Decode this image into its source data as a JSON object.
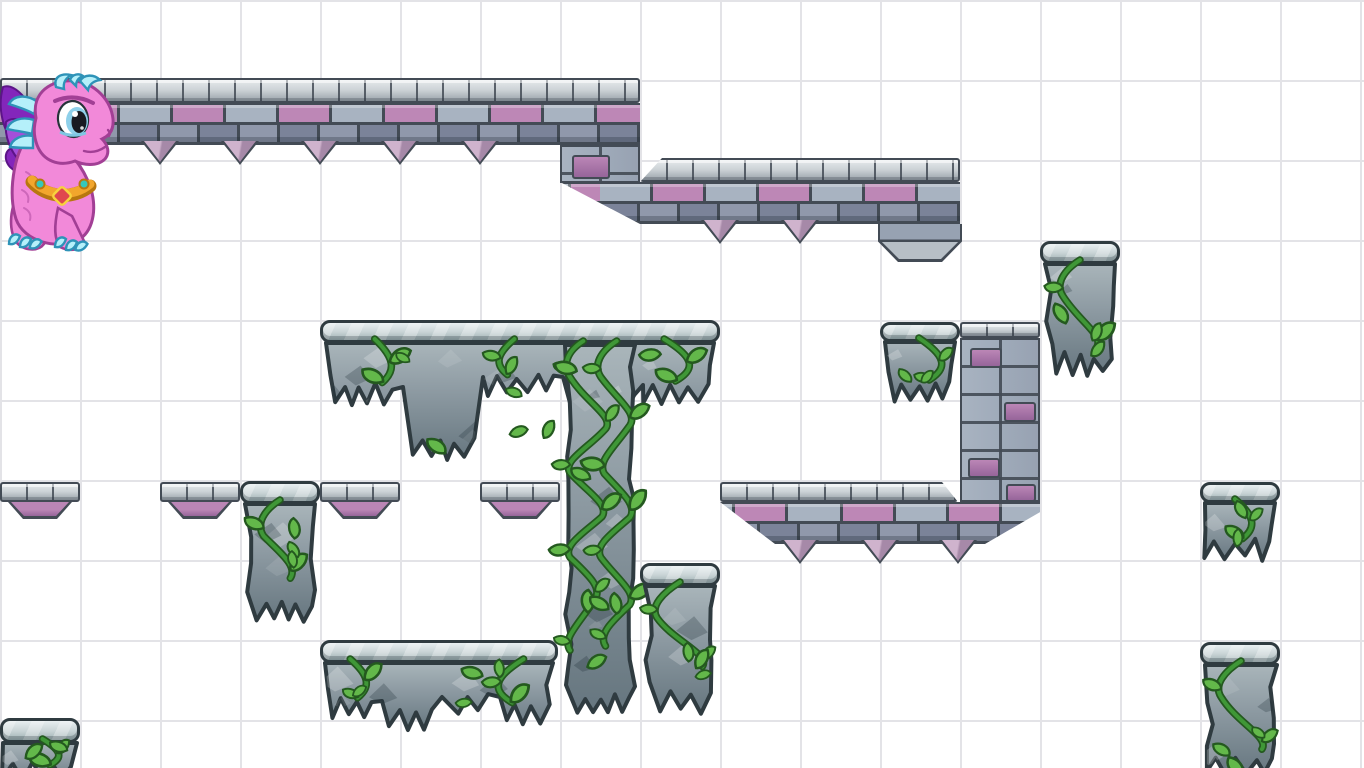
{
  "scene": {
    "width": 1364,
    "height": 768,
    "grid": {
      "cell": 80
    }
  },
  "palette": {
    "background": "#ffffff",
    "grid_line": "#e3e3e7",
    "outline": "#434b55",
    "cap_light": "#e6eaec",
    "cap_mid": "#ccd2d6",
    "cap_dark": "#9aa3aa",
    "brick_gray": "#a8b3c1",
    "brick_gray_dark": "#97a2b2",
    "brick_pink": "#bd87b6",
    "brick_row2": "#7b8399",
    "brick_row2_face": "#9098ab",
    "spike_light": "#cfb3cd",
    "spike_dark": "#a689a8",
    "pad_pink": "#bb86b6",
    "pad_pink_dark": "#96659a",
    "foot_light": "#b7bfc6",
    "moss_cap_light": "#e7eef0",
    "moss_cap_mid": "#c7d2d4",
    "moss_cap_dark": "#9db0b2",
    "rock_light": "#a9b5ba",
    "rock": "#8e9ba3",
    "rock_dark": "#66767f",
    "rock_outline": "#2f3b40",
    "vine": "#3f9737",
    "vine_dark": "#24591f",
    "leaf": "#63b84a",
    "dragon_body": "#f289d9",
    "dragon_outline": "#a23f95",
    "wing": "#8326bb",
    "wing_light": "#a44fd9",
    "horn": "#b5f0fa",
    "horn_outline": "#2e93b8",
    "collar": "#f2a62c",
    "collar_dark": "#b8770f",
    "gem_red": "#e0474e",
    "gem_teal": "#35c8b9",
    "eye_iris": "#8ed0ea"
  },
  "character": {
    "id": "pink-dragon",
    "x": 0,
    "y": 74,
    "w": 118,
    "h": 178,
    "facing": "right"
  },
  "tiles": {
    "castle": [
      {
        "id": "wall-top",
        "cap": {
          "x": 0,
          "y": 78,
          "w": 640,
          "h": 25
        },
        "body": {
          "x": 0,
          "y": 103,
          "w": 640,
          "h": 42
        },
        "spikes": {
          "y": 141,
          "xs": [
            160,
            240,
            320,
            400,
            480
          ]
        },
        "phase": 14
      },
      {
        "id": "wall-top-drop",
        "kind": "brick",
        "body": {
          "x": 560,
          "y": 145,
          "w": 80,
          "h": 38
        },
        "accents": [
          [
            10,
            8,
            38,
            24
          ]
        ]
      },
      {
        "id": "wall-mid",
        "cap": {
          "x": 640,
          "y": 158,
          "w": 320,
          "h": 24,
          "clip_l": 22
        },
        "body": {
          "x": 560,
          "y": 182,
          "w": 400,
          "h": 42,
          "bevel_bl": 80
        },
        "spikes": {
          "y": 220,
          "xs": [
            720,
            800
          ]
        },
        "phase": 40
      },
      {
        "id": "wall-mid-foot",
        "kind": "foot",
        "body": {
          "x": 878,
          "y": 224,
          "w": 84,
          "h": 38
        }
      },
      {
        "id": "tower-column",
        "cap": {
          "x": 960,
          "y": 322,
          "w": 80,
          "h": 16
        },
        "body": {
          "x": 960,
          "y": 338,
          "w": 80,
          "h": 164,
          "pattern": "column"
        },
        "accents": [
          [
            8,
            8,
            32,
            20
          ],
          [
            42,
            62,
            32,
            20
          ],
          [
            6,
            118,
            32,
            20
          ],
          [
            44,
            144,
            30,
            18
          ]
        ]
      },
      {
        "id": "ledge-right",
        "cap": {
          "x": 720,
          "y": 482,
          "w": 238,
          "h": 20,
          "clip_r": 16
        },
        "body": {
          "x": 720,
          "y": 502,
          "w": 320,
          "h": 42,
          "bevel_bl": 55,
          "bevel_br": 55
        },
        "spikes": {
          "y": 540,
          "xs": [
            800,
            880,
            958
          ]
        },
        "phase": 70
      },
      {
        "id": "block-a",
        "kind": "block",
        "cap": {
          "x": 0,
          "y": 482,
          "w": 80,
          "h": 20
        },
        "pad": {
          "h": 17
        }
      },
      {
        "id": "block-b",
        "kind": "block",
        "cap": {
          "x": 160,
          "y": 482,
          "w": 80,
          "h": 20
        },
        "pad": {
          "h": 17
        }
      },
      {
        "id": "block-c",
        "kind": "block",
        "cap": {
          "x": 320,
          "y": 482,
          "w": 80,
          "h": 20
        },
        "pad": {
          "h": 17
        }
      },
      {
        "id": "block-d",
        "kind": "block",
        "cap": {
          "x": 480,
          "y": 482,
          "w": 80,
          "h": 20
        },
        "pad": {
          "h": 17
        }
      }
    ],
    "mossy": [
      {
        "id": "shelf-top",
        "cap": {
          "x": 320,
          "y": 320,
          "w": 400,
          "h": 23
        },
        "body": {
          "x": 323,
          "y": 341,
          "w": 394,
          "profile": [
            [
              78,
              52
            ],
            [
              80,
              106
            ],
            [
              80,
              42
            ],
            [
              80,
              58
            ],
            [
              76,
              50
            ]
          ]
        },
        "vines": 3,
        "seed": 11
      },
      {
        "id": "pillar",
        "body": {
          "x": 562,
          "y": 343,
          "w": 76,
          "profile": [
            [
              76,
              360
            ]
          ]
        },
        "vines": 2,
        "seed": 22
      },
      {
        "id": "block-mid",
        "cap": {
          "x": 640,
          "y": 563,
          "w": 80,
          "h": 23
        },
        "body": {
          "x": 642,
          "y": 584,
          "w": 76,
          "profile": [
            [
              76,
              116
            ]
          ]
        },
        "vines": 1,
        "seed": 33
      },
      {
        "id": "shelf-bottom",
        "cap": {
          "x": 320,
          "y": 640,
          "w": 238,
          "h": 23
        },
        "body": {
          "x": 322,
          "y": 661,
          "w": 234,
          "profile": [
            [
              58,
              46
            ],
            [
              60,
              55
            ],
            [
              58,
              42
            ],
            [
              58,
              52
            ]
          ]
        },
        "vines": 2,
        "seed": 44
      },
      {
        "id": "tile-d",
        "cap": {
          "x": 880,
          "y": 322,
          "w": 80,
          "h": 20
        },
        "body": {
          "x": 882,
          "y": 340,
          "w": 76,
          "profile": [
            [
              76,
              50
            ]
          ]
        },
        "vines": 1,
        "seed": 55
      },
      {
        "id": "tile-f",
        "cap": {
          "x": 1040,
          "y": 241,
          "w": 80,
          "h": 23
        },
        "body": {
          "x": 1042,
          "y": 262,
          "w": 76,
          "profile": [
            [
              76,
              100
            ]
          ]
        },
        "vines": 1,
        "seed": 66
      },
      {
        "id": "tile-g",
        "cap": {
          "x": 1200,
          "y": 482,
          "w": 80,
          "h": 21
        },
        "body": {
          "x": 1202,
          "y": 501,
          "w": 76,
          "profile": [
            [
              76,
              47
            ]
          ]
        },
        "vines": 1,
        "seed": 77
      },
      {
        "id": "tile-h",
        "cap": {
          "x": 1200,
          "y": 642,
          "w": 80,
          "h": 23
        },
        "body": {
          "x": 1202,
          "y": 663,
          "w": 78,
          "profile": [
            [
              78,
              101
            ]
          ]
        },
        "vines": 1,
        "seed": 88
      },
      {
        "id": "hang-blob",
        "cap": {
          "x": 240,
          "y": 481,
          "w": 80,
          "h": 23
        },
        "body": {
          "x": 242,
          "y": 502,
          "w": 76,
          "profile": [
            [
              76,
              108
            ]
          ]
        },
        "vines": 1,
        "seed": 99
      },
      {
        "id": "corner-bl",
        "cap": {
          "x": 0,
          "y": 718,
          "w": 80,
          "h": 25
        },
        "body": {
          "x": 0,
          "y": 741,
          "w": 80,
          "profile": [
            [
              80,
              30
            ]
          ]
        },
        "vines": 1,
        "seed": 123
      }
    ]
  }
}
